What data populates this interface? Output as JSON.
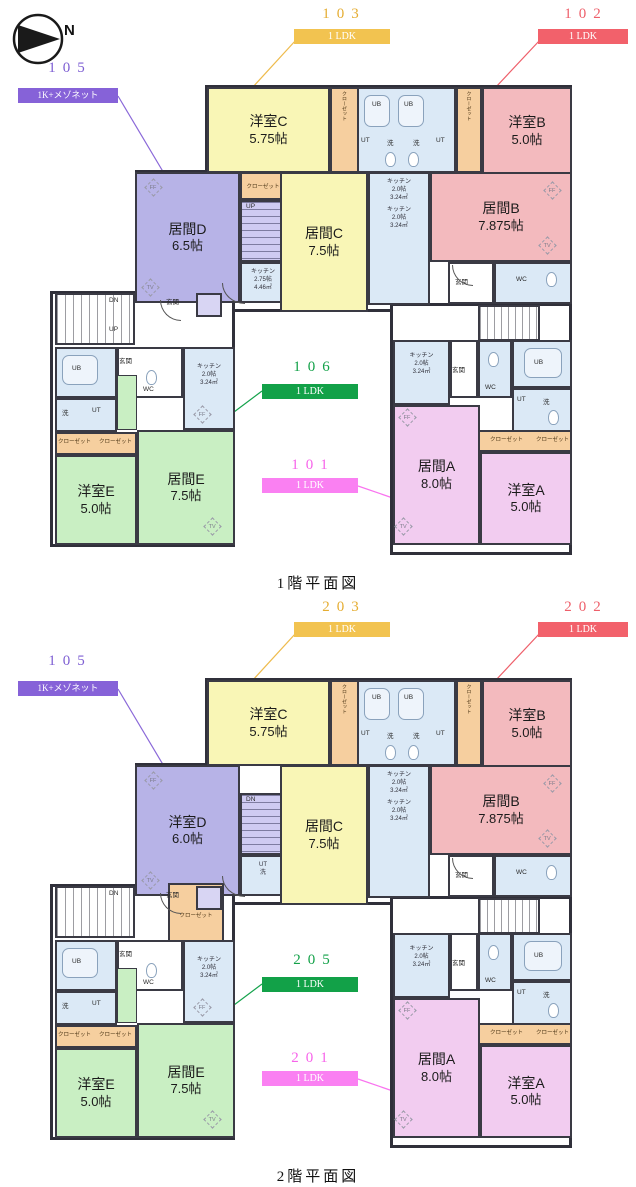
{
  "compass_label": "N",
  "palette": {
    "unit_105": "#7e5fd3",
    "unit_103": "#eebb4d",
    "unit_102": "#ee5f6a",
    "unit_106": "#12a148",
    "unit_101": "#f973ef",
    "room_yellow": "#f9f6b6",
    "room_pink": "#f3babe",
    "room_purple": "#b7b3e7",
    "room_green": "#c9efc3",
    "room_violet": "#f2ccf0",
    "utility_blue": "#dbe9f6",
    "closet_orange": "#f6cf9f",
    "wall": "#30303a"
  },
  "shared": {
    "fixtures": {
      "ub": "UB",
      "ut": "UT",
      "wash": "洗",
      "wc": "WC",
      "genkan": "玄関",
      "closet": "クローゼット",
      "ff": "FF",
      "tv": "TV"
    },
    "kitchen_small": {
      "t": "キッチン",
      "s": "2.0帖",
      "a": "3.24㎡"
    }
  },
  "floors": [
    {
      "caption": "1階平面図",
      "units": {
        "left": {
          "number": "105",
          "type": "1K+メゾネット"
        },
        "top_left": {
          "number": "103",
          "type": "1 LDK"
        },
        "top_right": {
          "number": "102",
          "type": "1 LDK"
        },
        "mid": {
          "number": "106",
          "type": "1 LDK"
        },
        "bottom": {
          "number": "101",
          "type": "1 LDK"
        }
      },
      "rooms": {
        "c": {
          "name": "洋室C",
          "size": "5.75帖"
        },
        "b": {
          "name": "洋室B",
          "size": "5.0帖"
        },
        "d": {
          "name": "居間D",
          "size": "6.5帖"
        },
        "cc": {
          "name": "居間C",
          "size": "7.5帖"
        },
        "bb": {
          "name": "居間B",
          "size": "7.875帖"
        },
        "e": {
          "name": "洋室E",
          "size": "5.0帖"
        },
        "ee": {
          "name": "居間E",
          "size": "7.5帖"
        },
        "a": {
          "name": "居間A",
          "size": "8.0帖"
        },
        "aa": {
          "name": "洋室A",
          "size": "5.0帖"
        }
      },
      "kitchen_d": {
        "t": "キッチン",
        "s": "2.75帖",
        "a": "4.46㎡"
      },
      "stairs": {
        "mid": "UP",
        "left_top": "DN",
        "left_bottom": "UP"
      }
    },
    {
      "caption": "2階平面図",
      "units": {
        "left": {
          "number": "105",
          "type": "1K+メゾネット"
        },
        "top_left": {
          "number": "203",
          "type": "1 LDK"
        },
        "top_right": {
          "number": "202",
          "type": "1 LDK"
        },
        "mid": {
          "number": "205",
          "type": "1 LDK"
        },
        "bottom": {
          "number": "201",
          "type": "1 LDK"
        }
      },
      "rooms": {
        "c": {
          "name": "洋室C",
          "size": "5.75帖"
        },
        "b": {
          "name": "洋室B",
          "size": "5.0帖"
        },
        "d": {
          "name": "洋室D",
          "size": "6.0帖"
        },
        "cc": {
          "name": "居間C",
          "size": "7.5帖"
        },
        "bb": {
          "name": "居間B",
          "size": "7.875帖"
        },
        "e": {
          "name": "洋室E",
          "size": "5.0帖"
        },
        "ee": {
          "name": "居間E",
          "size": "7.5帖"
        },
        "a": {
          "name": "居間A",
          "size": "8.0帖"
        },
        "aa": {
          "name": "洋室A",
          "size": "5.0帖"
        }
      },
      "kitchen_d": {
        "t": "UT",
        "s": "洗",
        "a": ""
      },
      "stairs": {
        "mid": "DN",
        "left_top": "DN",
        "left_bottom": ""
      }
    }
  ]
}
